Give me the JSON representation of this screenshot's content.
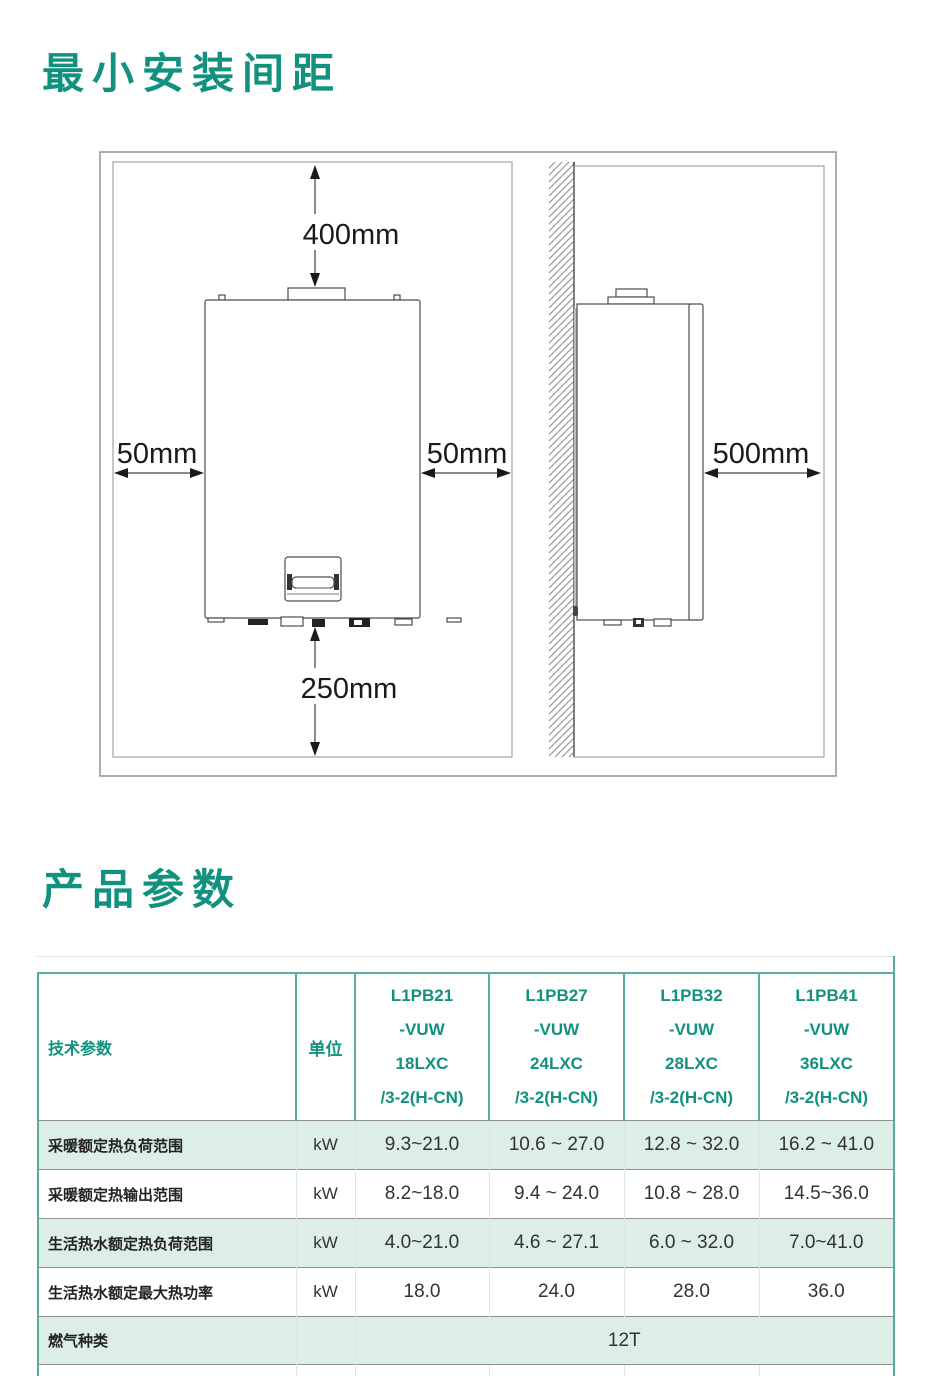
{
  "install_section": {
    "title": "最小安装间距",
    "dimensions": {
      "top": "400mm",
      "left": "50mm",
      "right": "50mm",
      "bottom": "250mm",
      "side": "500mm"
    }
  },
  "params_section": {
    "title": "产品参数",
    "table": {
      "param_header": "技术参数",
      "unit_header": "单位",
      "models": [
        "L1PB21\n-VUW\n18LXC\n/3-2(H-CN)",
        "L1PB27\n-VUW\n24LXC\n/3-2(H-CN)",
        "L1PB32\n-VUW\n28LXC\n/3-2(H-CN)",
        "L1PB41\n-VUW\n36LXC\n/3-2(H-CN)"
      ],
      "rows": [
        {
          "label": "采暖额定热负荷范围",
          "unit": "kW",
          "values": [
            "9.3~21.0",
            "10.6 ~ 27.0",
            "12.8 ~ 32.0",
            "16.2 ~ 41.0"
          ]
        },
        {
          "label": "采暖额定热输出范围",
          "unit": "kW",
          "values": [
            "8.2~18.0",
            "9.4 ~ 24.0",
            "10.8 ~ 28.0",
            "14.5~36.0"
          ]
        },
        {
          "label": "生活热水额定热负荷范围",
          "unit": "kW",
          "values": [
            "4.0~21.0",
            "4.6 ~ 27.1",
            "6.0 ~ 32.0",
            "7.0~41.0"
          ]
        },
        {
          "label": "生活热水额定最大热功率",
          "unit": "kW",
          "values": [
            "18.0",
            "24.0",
            "28.0",
            "36.0"
          ]
        },
        {
          "label": "燃气种类",
          "unit": "",
          "merged_value": "12T"
        }
      ]
    }
  },
  "colors": {
    "accent_teal": "#12917F",
    "table_border": "#58ACA0",
    "row_shade": "#DDEDE8"
  }
}
